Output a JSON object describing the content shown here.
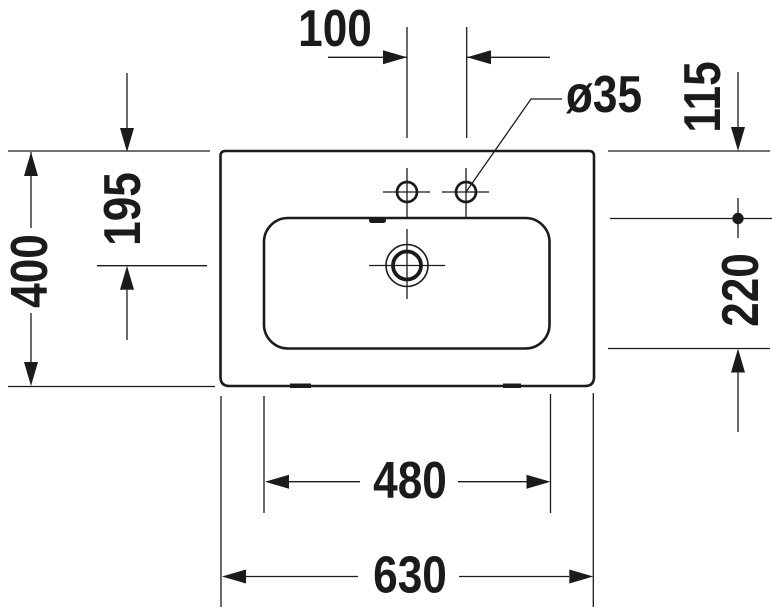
{
  "drawing": {
    "title": "Washbasin technical drawing, top view",
    "colors": {
      "line": "#1b1b1b",
      "background": "#ffffff"
    },
    "dimensions": {
      "faucet_hole_spacing": "100",
      "faucet_hole_diameter": "ø35",
      "rim_to_bowl_front": "115",
      "bowl_depth": "220",
      "total_depth": "400",
      "rim_to_drain_center": "195",
      "bowl_width": "480",
      "total_width": "630"
    }
  }
}
